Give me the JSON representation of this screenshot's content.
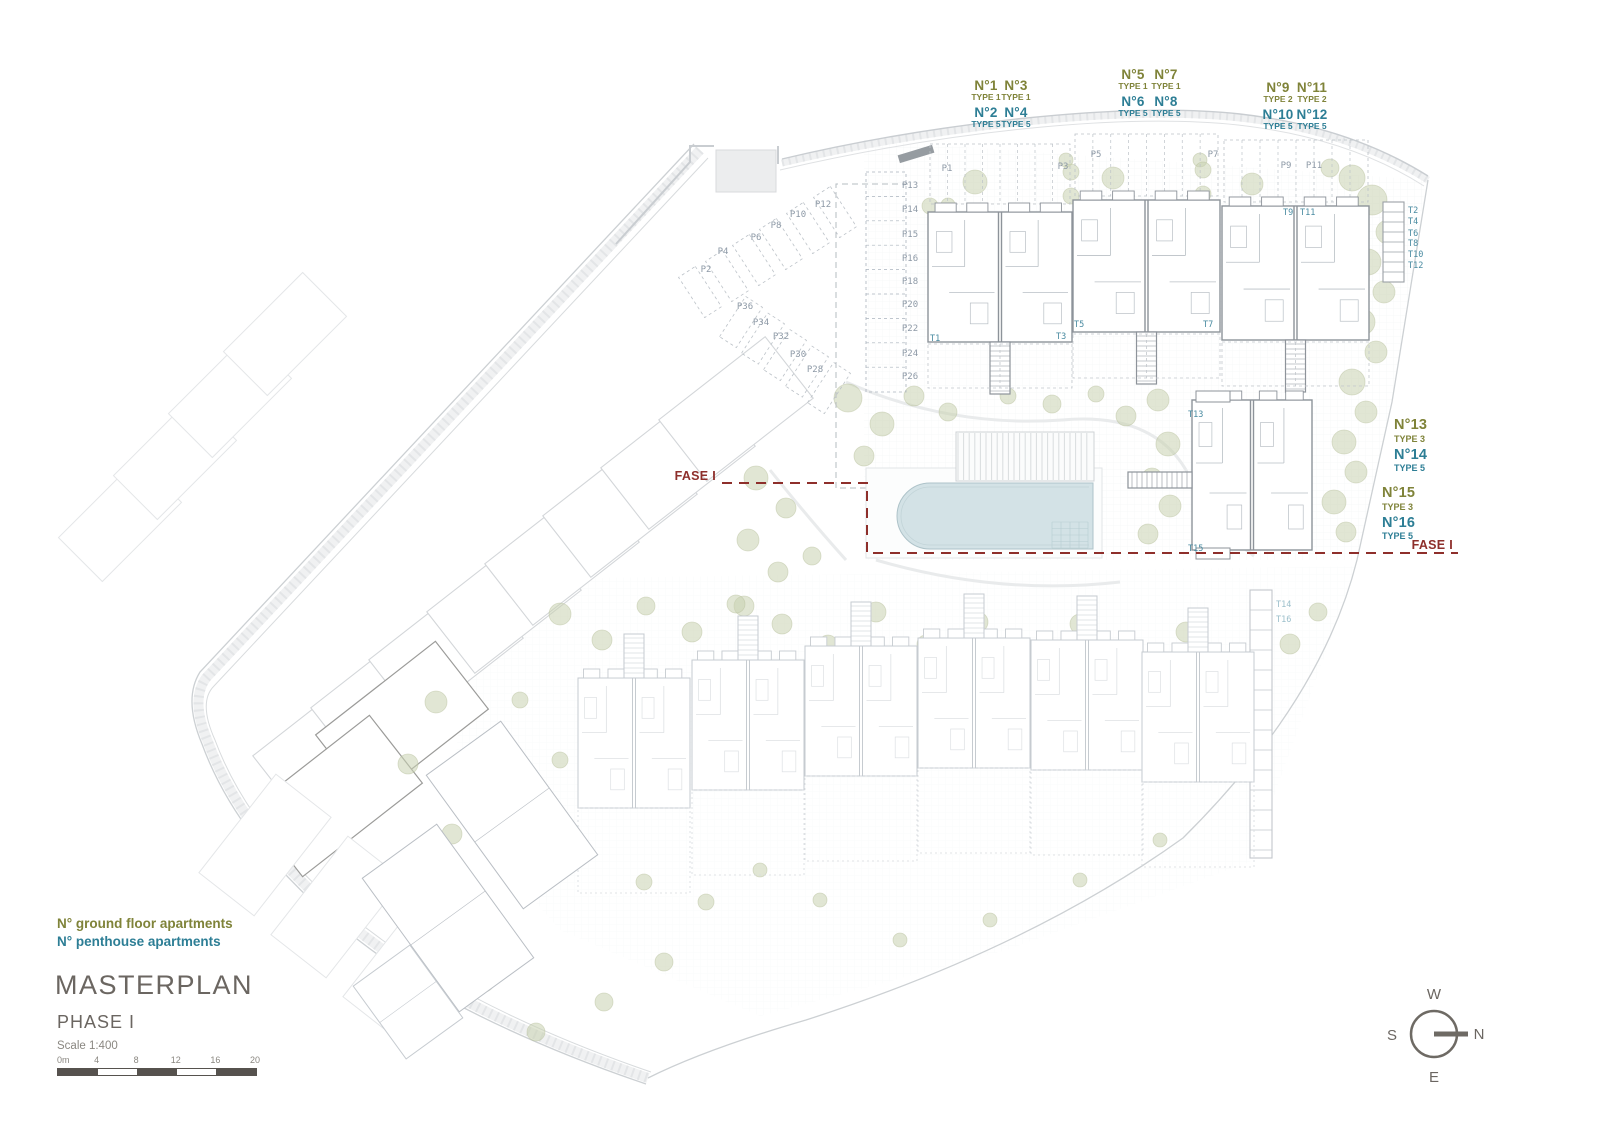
{
  "colors": {
    "ground_floor_text": "#7f8339",
    "penthouse_text": "#2d7e95",
    "phase_line": "#8e2f2b",
    "title_text": "#6b6661",
    "parking_text": "#8d99a6",
    "storage_text": "#4a8ba1",
    "pool_fill": "#d3e2e6",
    "tree_fill": "#c9d1b0"
  },
  "top_unit_groups": [
    {
      "ground": [
        {
          "no": "N°1",
          "type": "TYPE 1"
        },
        {
          "no": "N°3",
          "type": "TYPE 1"
        }
      ],
      "penthouse": [
        {
          "no": "N°2",
          "type": "TYPE 5"
        },
        {
          "no": "N°4",
          "type": "TYPE 5"
        }
      ]
    },
    {
      "ground": [
        {
          "no": "N°5",
          "type": "TYPE 1"
        },
        {
          "no": "N°7",
          "type": "TYPE 1"
        }
      ],
      "penthouse": [
        {
          "no": "N°6",
          "type": "TYPE 5"
        },
        {
          "no": "N°8",
          "type": "TYPE 5"
        }
      ]
    },
    {
      "ground": [
        {
          "no": "N°9",
          "type": "TYPE 2"
        },
        {
          "no": "N°11",
          "type": "TYPE 2"
        }
      ],
      "penthouse": [
        {
          "no": "N°10",
          "type": "TYPE 5"
        },
        {
          "no": "N°12",
          "type": "TYPE 5"
        }
      ]
    }
  ],
  "right_units": [
    {
      "no": "N°13",
      "type": "TYPE 3"
    },
    {
      "no": "N°14",
      "type": "TYPE 5"
    },
    {
      "no": "N°15",
      "type": "TYPE 3"
    },
    {
      "no": "N°16",
      "type": "TYPE 5"
    }
  ],
  "phase_boundary": {
    "label_left": "FASE I",
    "label_right": "FASE I"
  },
  "parking_labels": {
    "top_row": [
      "P1",
      "P3",
      "P5",
      "P7",
      "P9",
      "P11"
    ],
    "left_column": [
      "P13",
      "P14",
      "P15",
      "P16",
      "P18",
      "P20",
      "P22",
      "P24",
      "P26"
    ],
    "upper_diagonal": [
      "P2",
      "P4",
      "P6",
      "P8",
      "P10",
      "P12"
    ],
    "lower_diagonal": [
      "P36",
      "P34",
      "P32",
      "P30",
      "P28"
    ]
  },
  "storage_labels": {
    "right_column": [
      "T2",
      "T4",
      "T6",
      "T8",
      "T10",
      "T12"
    ],
    "block_tags": [
      "T1",
      "T3",
      "T5",
      "T7",
      "T9",
      "T11"
    ],
    "mid_block_tags": [
      "T13",
      "T15"
    ],
    "phase2_tags": [
      "T14",
      "T16"
    ]
  },
  "legend": {
    "ground_floor": "N° ground floor apartments",
    "penthouse": "N° penthouse apartments"
  },
  "title_block": {
    "title": "MASTERPLAN",
    "phase": "PHASE I",
    "scale": "Scale 1:400"
  },
  "scale_bar": {
    "ticks": [
      "0m",
      "4",
      "8",
      "12",
      "16",
      "20"
    ]
  },
  "compass": {
    "top": "W",
    "right": "N",
    "left": "S",
    "bottom": "E"
  }
}
